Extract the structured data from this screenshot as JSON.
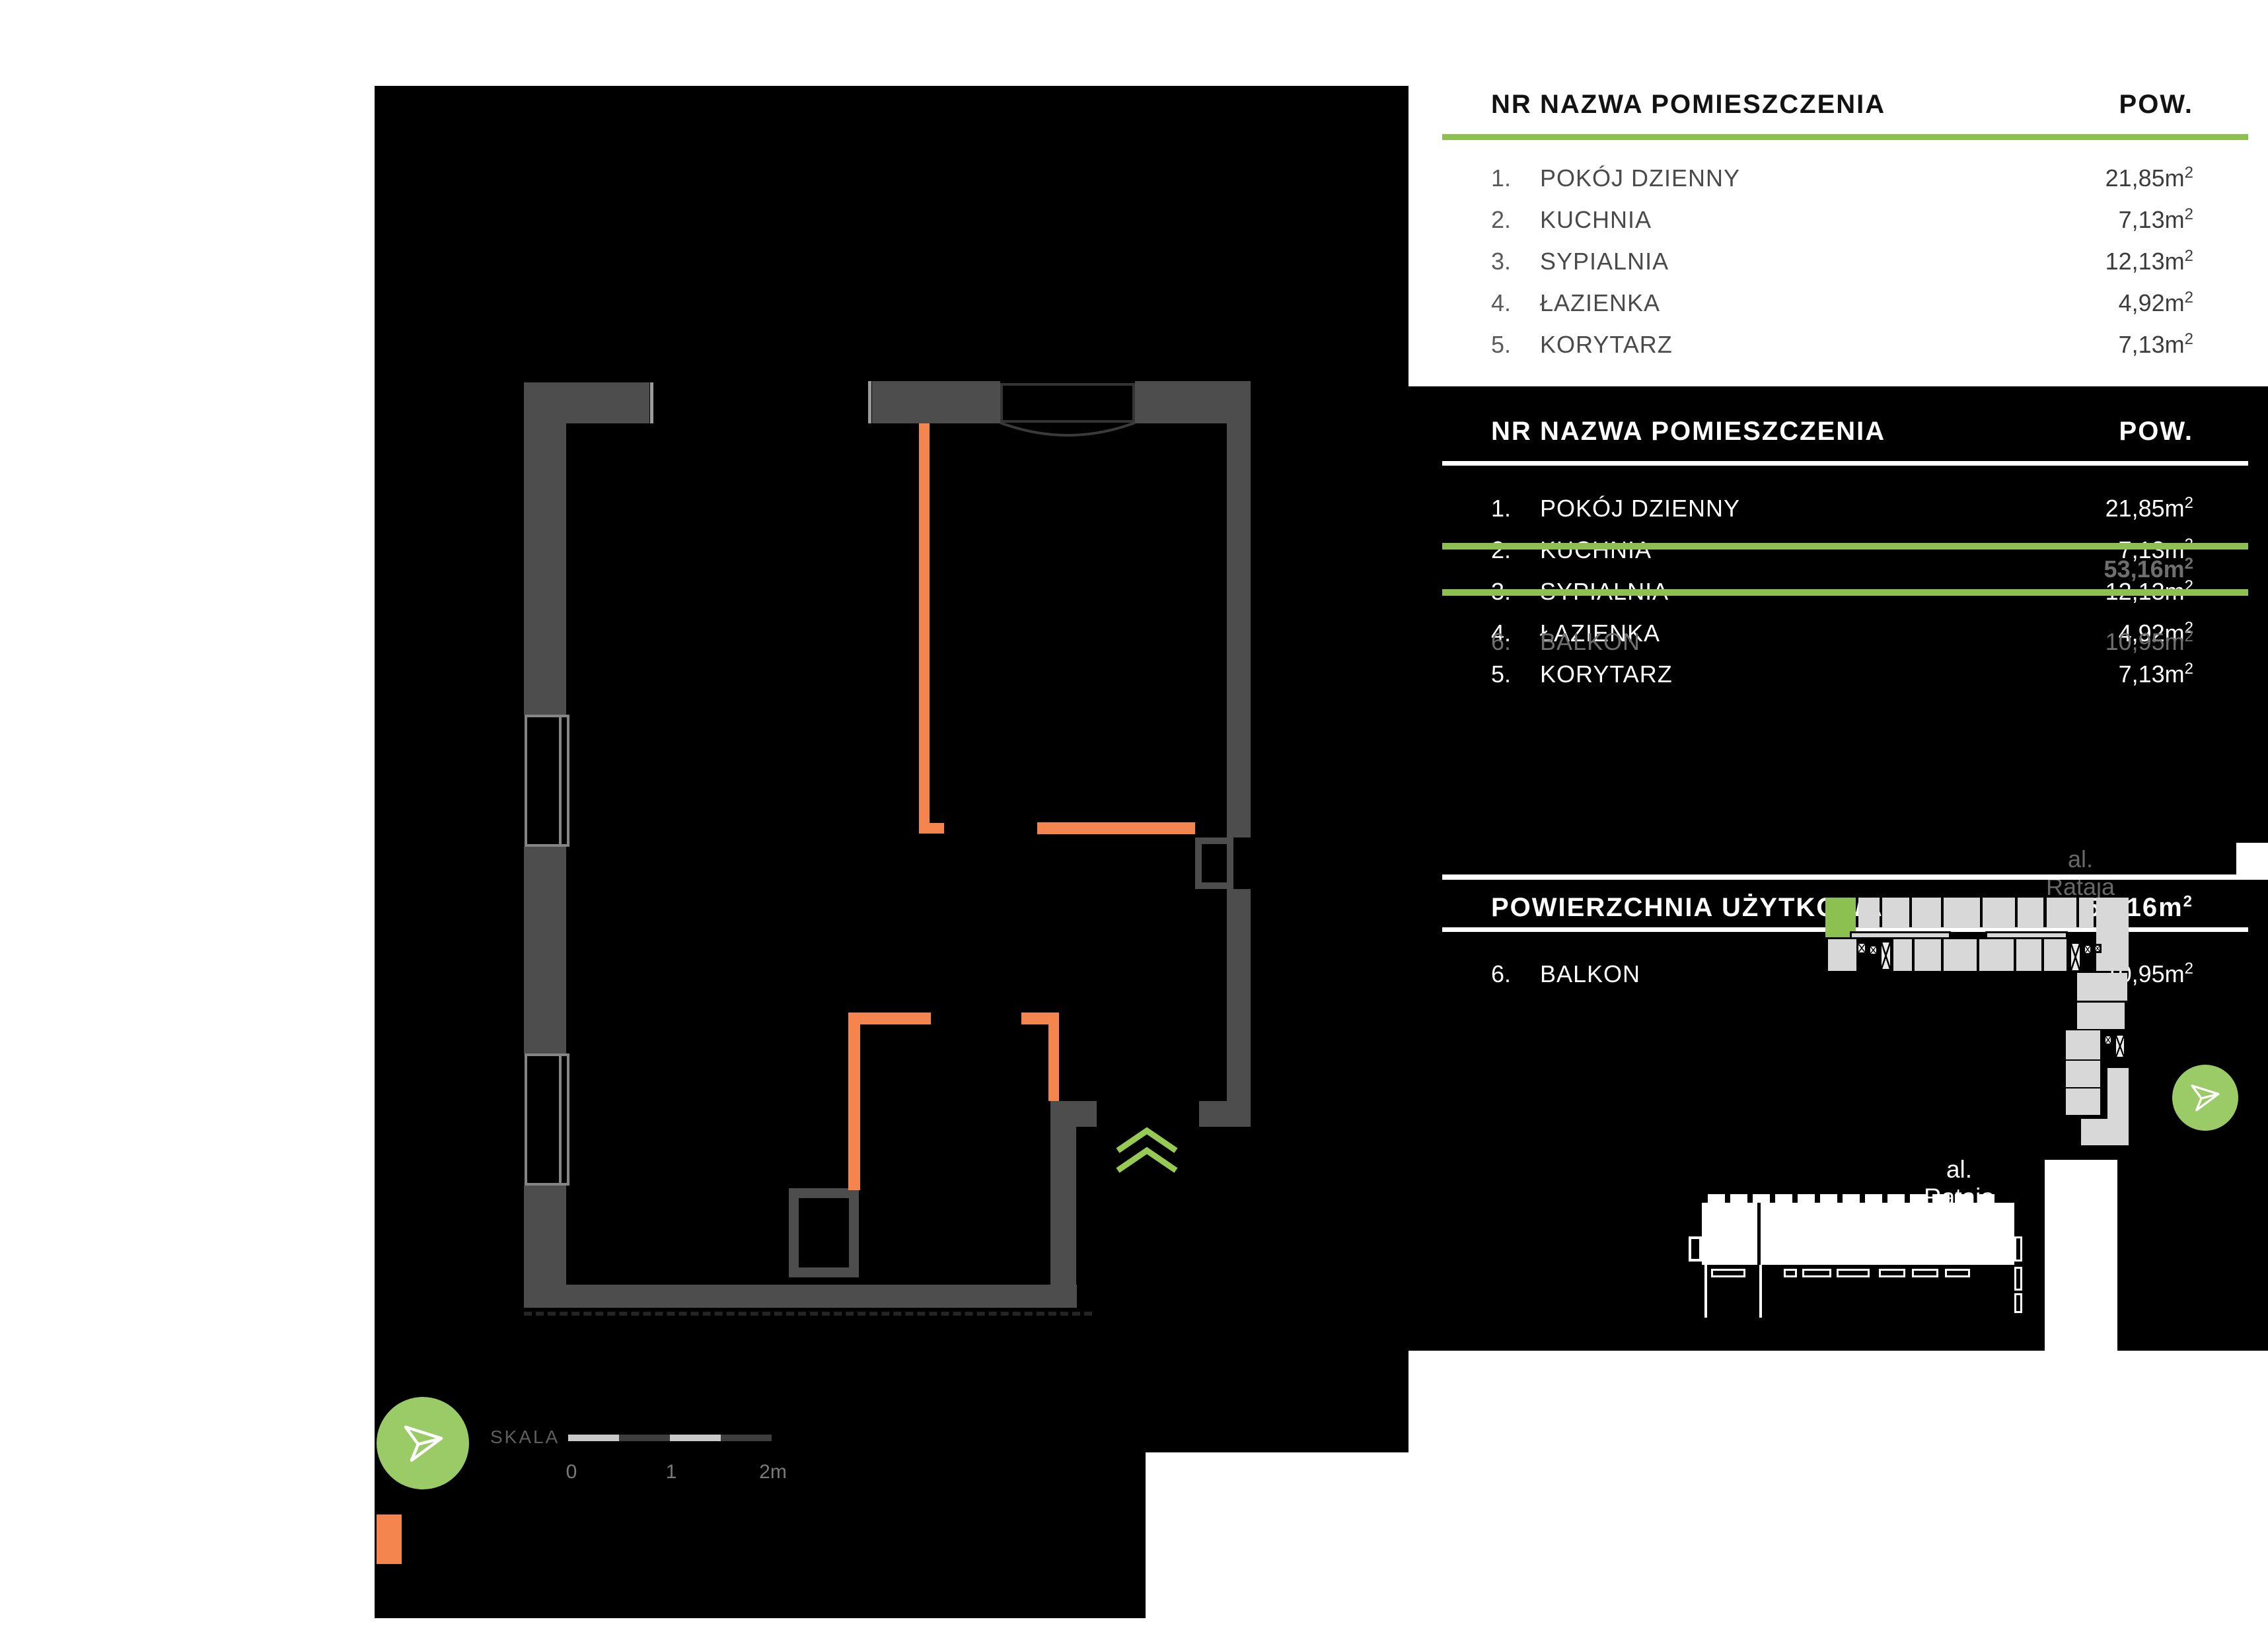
{
  "colors": {
    "accent_green": "#8CC152",
    "circle_green": "#9BCB66",
    "accent_orange": "#F4854F",
    "wall_gray": "#4D4D4D",
    "panel_black": "#000000",
    "site_gray": "#D8D8D8",
    "ghost_gray": "#6F6F6F",
    "street_gray_upper": "#686868",
    "scale_light": "#C9C9C9",
    "scale_dark": "#3E3E3E"
  },
  "room_table": {
    "headers": {
      "nr": "NR",
      "name": "NAZWA POMIESZCZENIA",
      "pow": "POW."
    },
    "rows": [
      {
        "nr": "1.",
        "name": "POKÓJ DZIENNY",
        "value": "21,85m",
        "sup": "2"
      },
      {
        "nr": "2.",
        "name": "KUCHNIA",
        "value": "7,13m",
        "sup": "2"
      },
      {
        "nr": "3.",
        "name": "SYPIALNIA",
        "value": "12,13m",
        "sup": "2"
      },
      {
        "nr": "4.",
        "name": "ŁAZIENKA",
        "value": "4,92m",
        "sup": "2"
      },
      {
        "nr": "5.",
        "name": "KORYTARZ",
        "value": "7,13m",
        "sup": "2"
      }
    ]
  },
  "summary": {
    "title": "POWIERZCHNIA UŻYTKOWA",
    "total": "53,16m",
    "total_sup": "2",
    "balcony": {
      "nr": "6.",
      "name": "BALKON",
      "value": "10,95m",
      "sup": "2"
    }
  },
  "streets": {
    "upper": "al. Rataja",
    "lower": "al. Rataja"
  },
  "scalebar": {
    "label": "SKALA",
    "tick0": "0",
    "tick1": "1",
    "tick2": "2m"
  },
  "icons": {
    "north": "paper-plane-north-arrow",
    "entrance": "double-chevron-up",
    "highlight_unit": "selected-apartment-unit"
  }
}
